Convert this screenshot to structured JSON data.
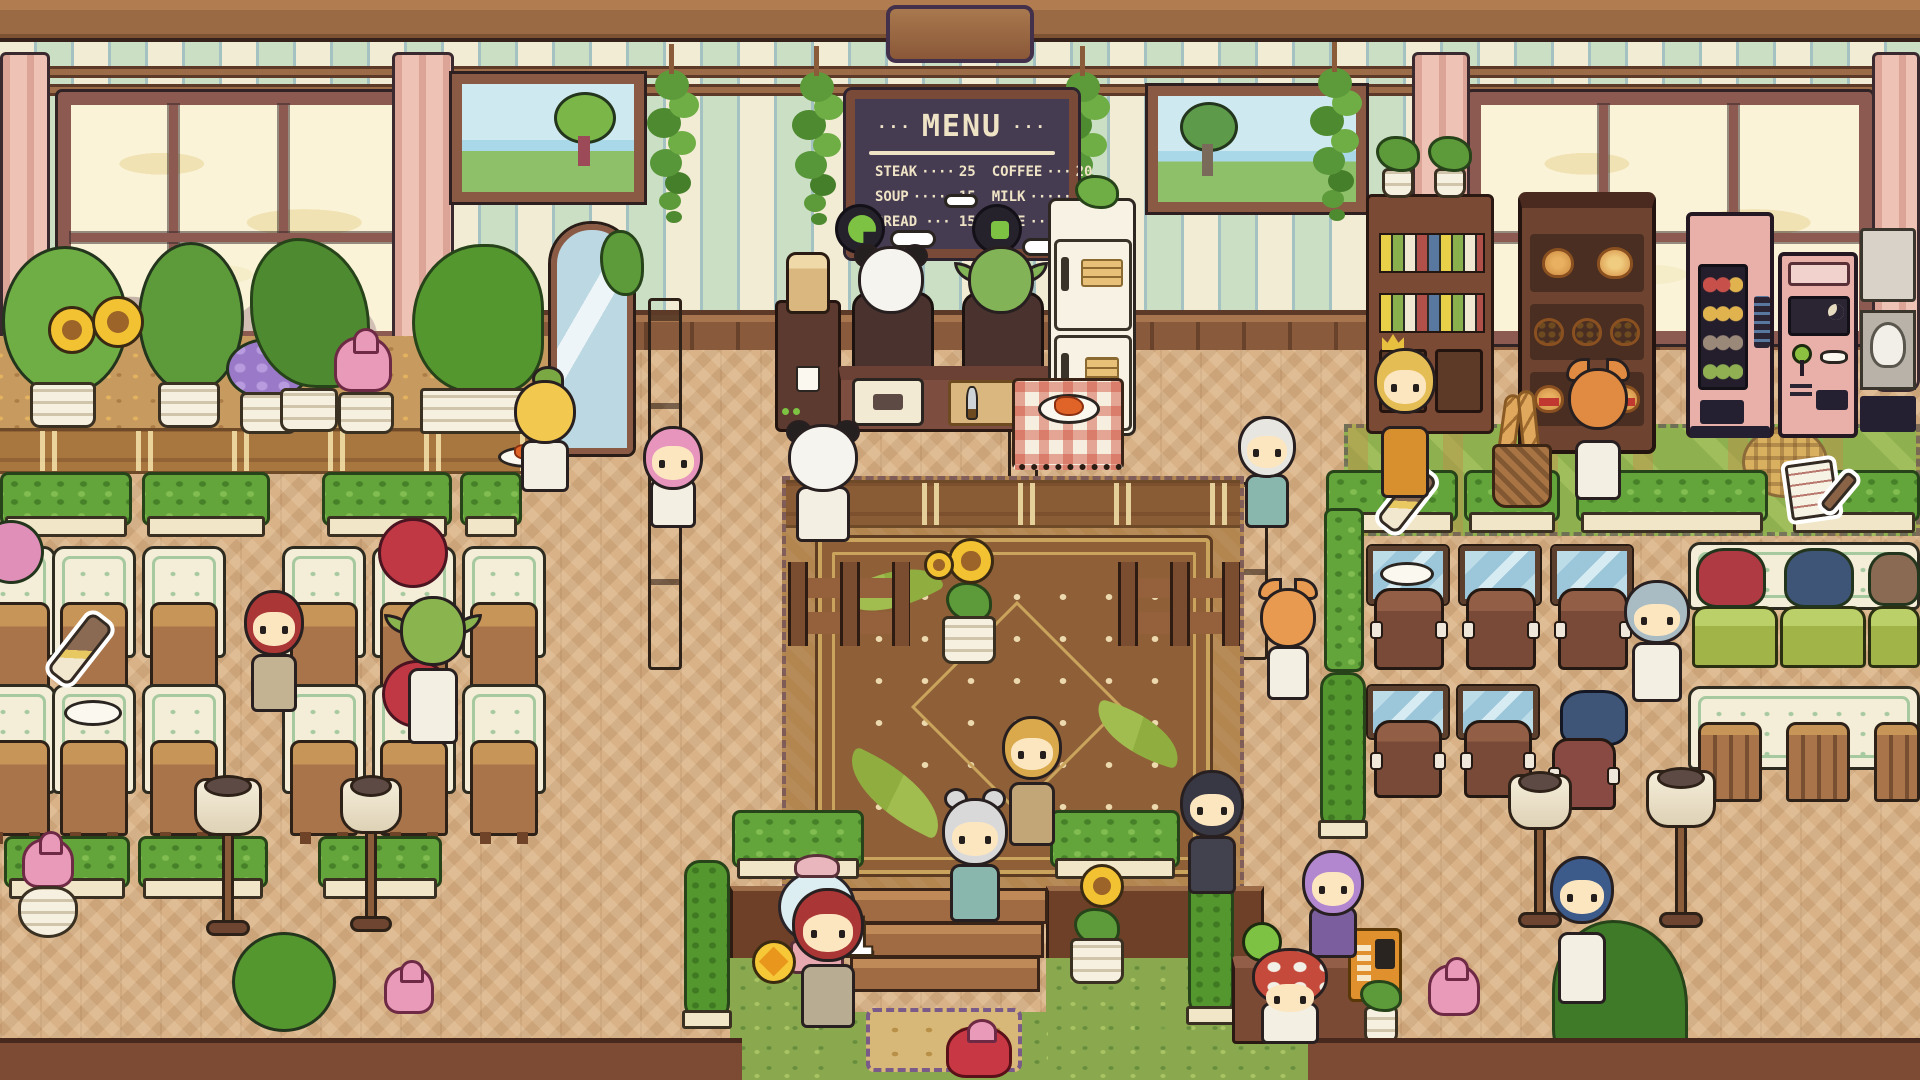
{
  "scene": {
    "name": "Cozy pixel cafe interior"
  },
  "menu_board": {
    "decor_left": "···",
    "title": "MENU",
    "decor_right": "···",
    "left_column": [
      {
        "item": "STEAK",
        "dots": "····",
        "price": "25"
      },
      {
        "item": "SOUP",
        "dots": "·····",
        "price": "15"
      },
      {
        "item": "BREAD",
        "dots": "···",
        "price": "15"
      }
    ],
    "right_column": [
      {
        "item": "COFFEE",
        "dots": "···",
        "price": "20"
      },
      {
        "item": "MILK",
        "dots": "·····",
        "price": "15"
      },
      {
        "item": "CAKE",
        "dots": "·····",
        "price": "25"
      }
    ]
  },
  "popup": {
    "coin_gain": "+1"
  },
  "icons": {
    "coin": "coin-icon",
    "brush_pickup": "cleaning-brush-icon",
    "note_pickup": "order-note-icon",
    "chef_status": "cooking-status-icon"
  },
  "colors": {
    "wall_cream": "#f2ecd4",
    "wall_sage": "#cbdfc4",
    "beam_brown": "#9a6a44",
    "floor_tan": "#d9b287",
    "menu_bg": "#463c52",
    "menu_text": "#efe3c6",
    "hedge_green": "#63a53b",
    "curtain_pink": "#eec2b5",
    "coin_yellow": "#f6c838"
  }
}
